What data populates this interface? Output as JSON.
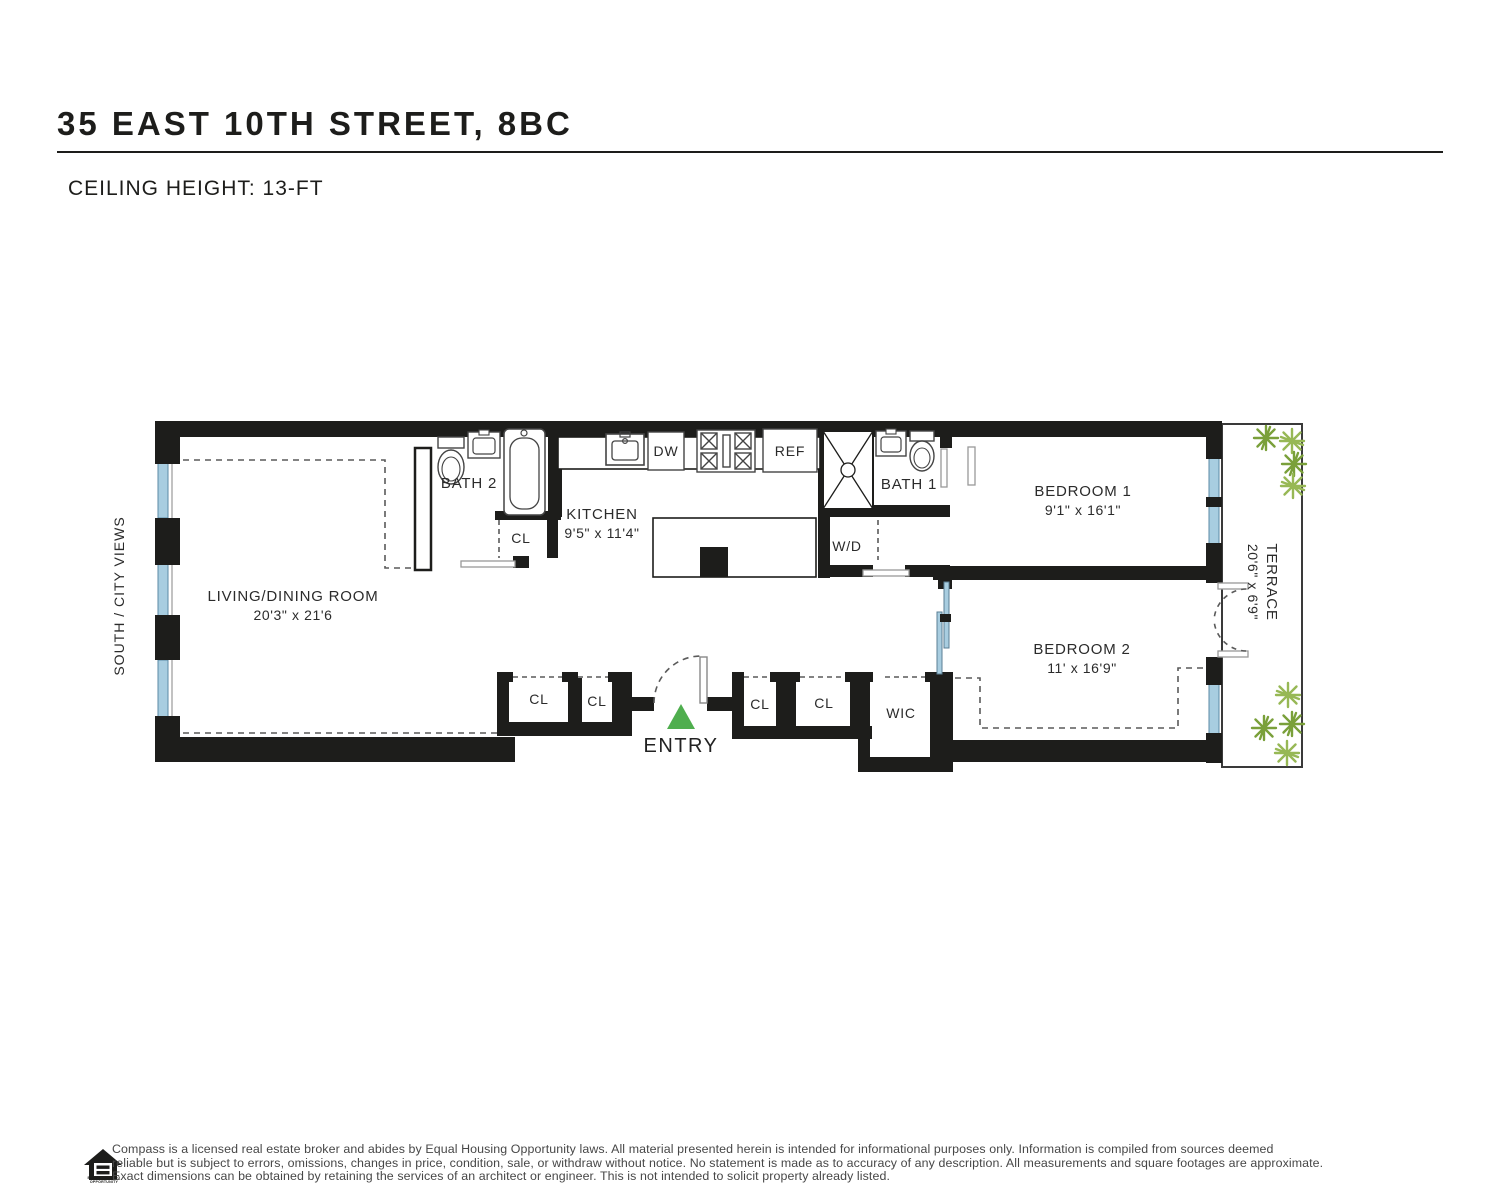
{
  "header": {
    "title": "35 EAST 10TH STREET, 8BC",
    "subtitle": "CEILING HEIGHT: 13-FT"
  },
  "plan": {
    "orientation_label": "SOUTH / CITY VIEWS",
    "entry_label": "ENTRY",
    "closet_label": "CL",
    "wic_label": "WIC",
    "wd_label": "W/D",
    "rooms": {
      "living": {
        "name": "LIVING/DINING ROOM",
        "dims": "20'3\" x 21'6"
      },
      "kitchen": {
        "name": "KITCHEN",
        "dims": "9'5\" x 11'4\""
      },
      "bath2": {
        "name": "BATH 2"
      },
      "bath1": {
        "name": "BATH 1"
      },
      "bedroom1": {
        "name": "BEDROOM 1",
        "dims": "9'1\" x 16'1\""
      },
      "bedroom2": {
        "name": "BEDROOM 2",
        "dims": "11' x 16'9\""
      },
      "terrace": {
        "name": "TERRACE",
        "dims": "20'6\" x 6'9\""
      }
    },
    "appliances": {
      "dishwasher": "DW",
      "refrigerator": "REF"
    },
    "colors": {
      "wall": "#1d1d1b",
      "window_glass": "#a8cde0",
      "entry_marker": "#4fae4e",
      "plant_dark": "#7aa03a",
      "plant_light": "#97b855",
      "dashed_line": "#5a5a5a"
    }
  },
  "footer": {
    "logo_caption": "EQUAL HOUSING OPPORTUNITY",
    "lines": [
      "Compass is a licensed real estate broker and abides by Equal Housing Opportunity laws. All material presented herein is intended for informational purposes only. Information is compiled from sources deemed",
      "reliable but is subject to errors, omissions, changes in price, condition, sale, or withdraw without notice. No statement is made as to accuracy of any description. All measurements and square footages are approximate.",
      "Exact dimensions can be obtained by retaining the services of an architect or engineer. This is not intended to solicit property already listed."
    ]
  }
}
